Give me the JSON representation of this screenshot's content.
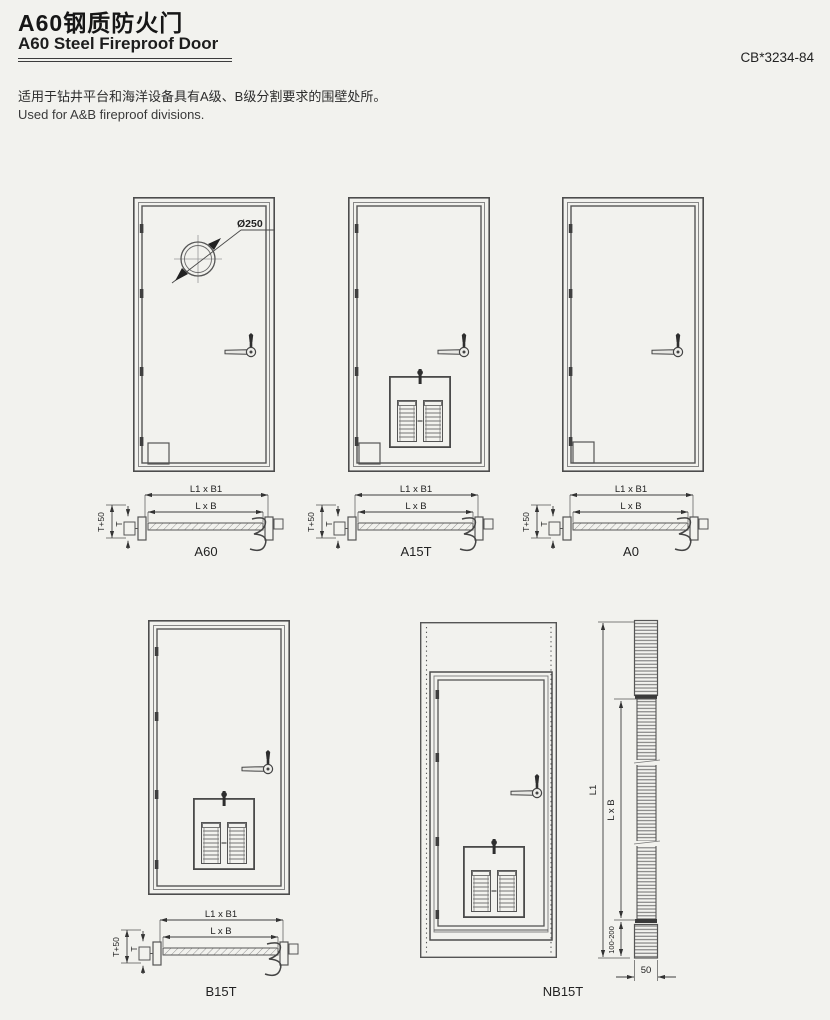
{
  "page": {
    "title_zh": "A60钢质防火门",
    "title_en": "A60 Steel Fireproof Door",
    "standard_code": "CB*3234-84",
    "description_zh": "适用于钻井平台和海洋设备具有A级、B级分割要求的围壁处所。",
    "description_en": "Used for A&B fireproof divisions."
  },
  "diagram": {
    "porthole_diameter": "Ø250",
    "dims": {
      "outer": "L1 x B1",
      "clear": "L x B",
      "t_plus_50": "T+50",
      "t": "T",
      "height_outer": "L1",
      "height_clear": "L x B",
      "bottom_clearance": "100-200",
      "panel_thickness": "50"
    },
    "door_labels": {
      "a60": "A60",
      "a15t": "A15T",
      "a0": "A0",
      "b15t": "B15T",
      "nb15t": "NB15T"
    }
  }
}
